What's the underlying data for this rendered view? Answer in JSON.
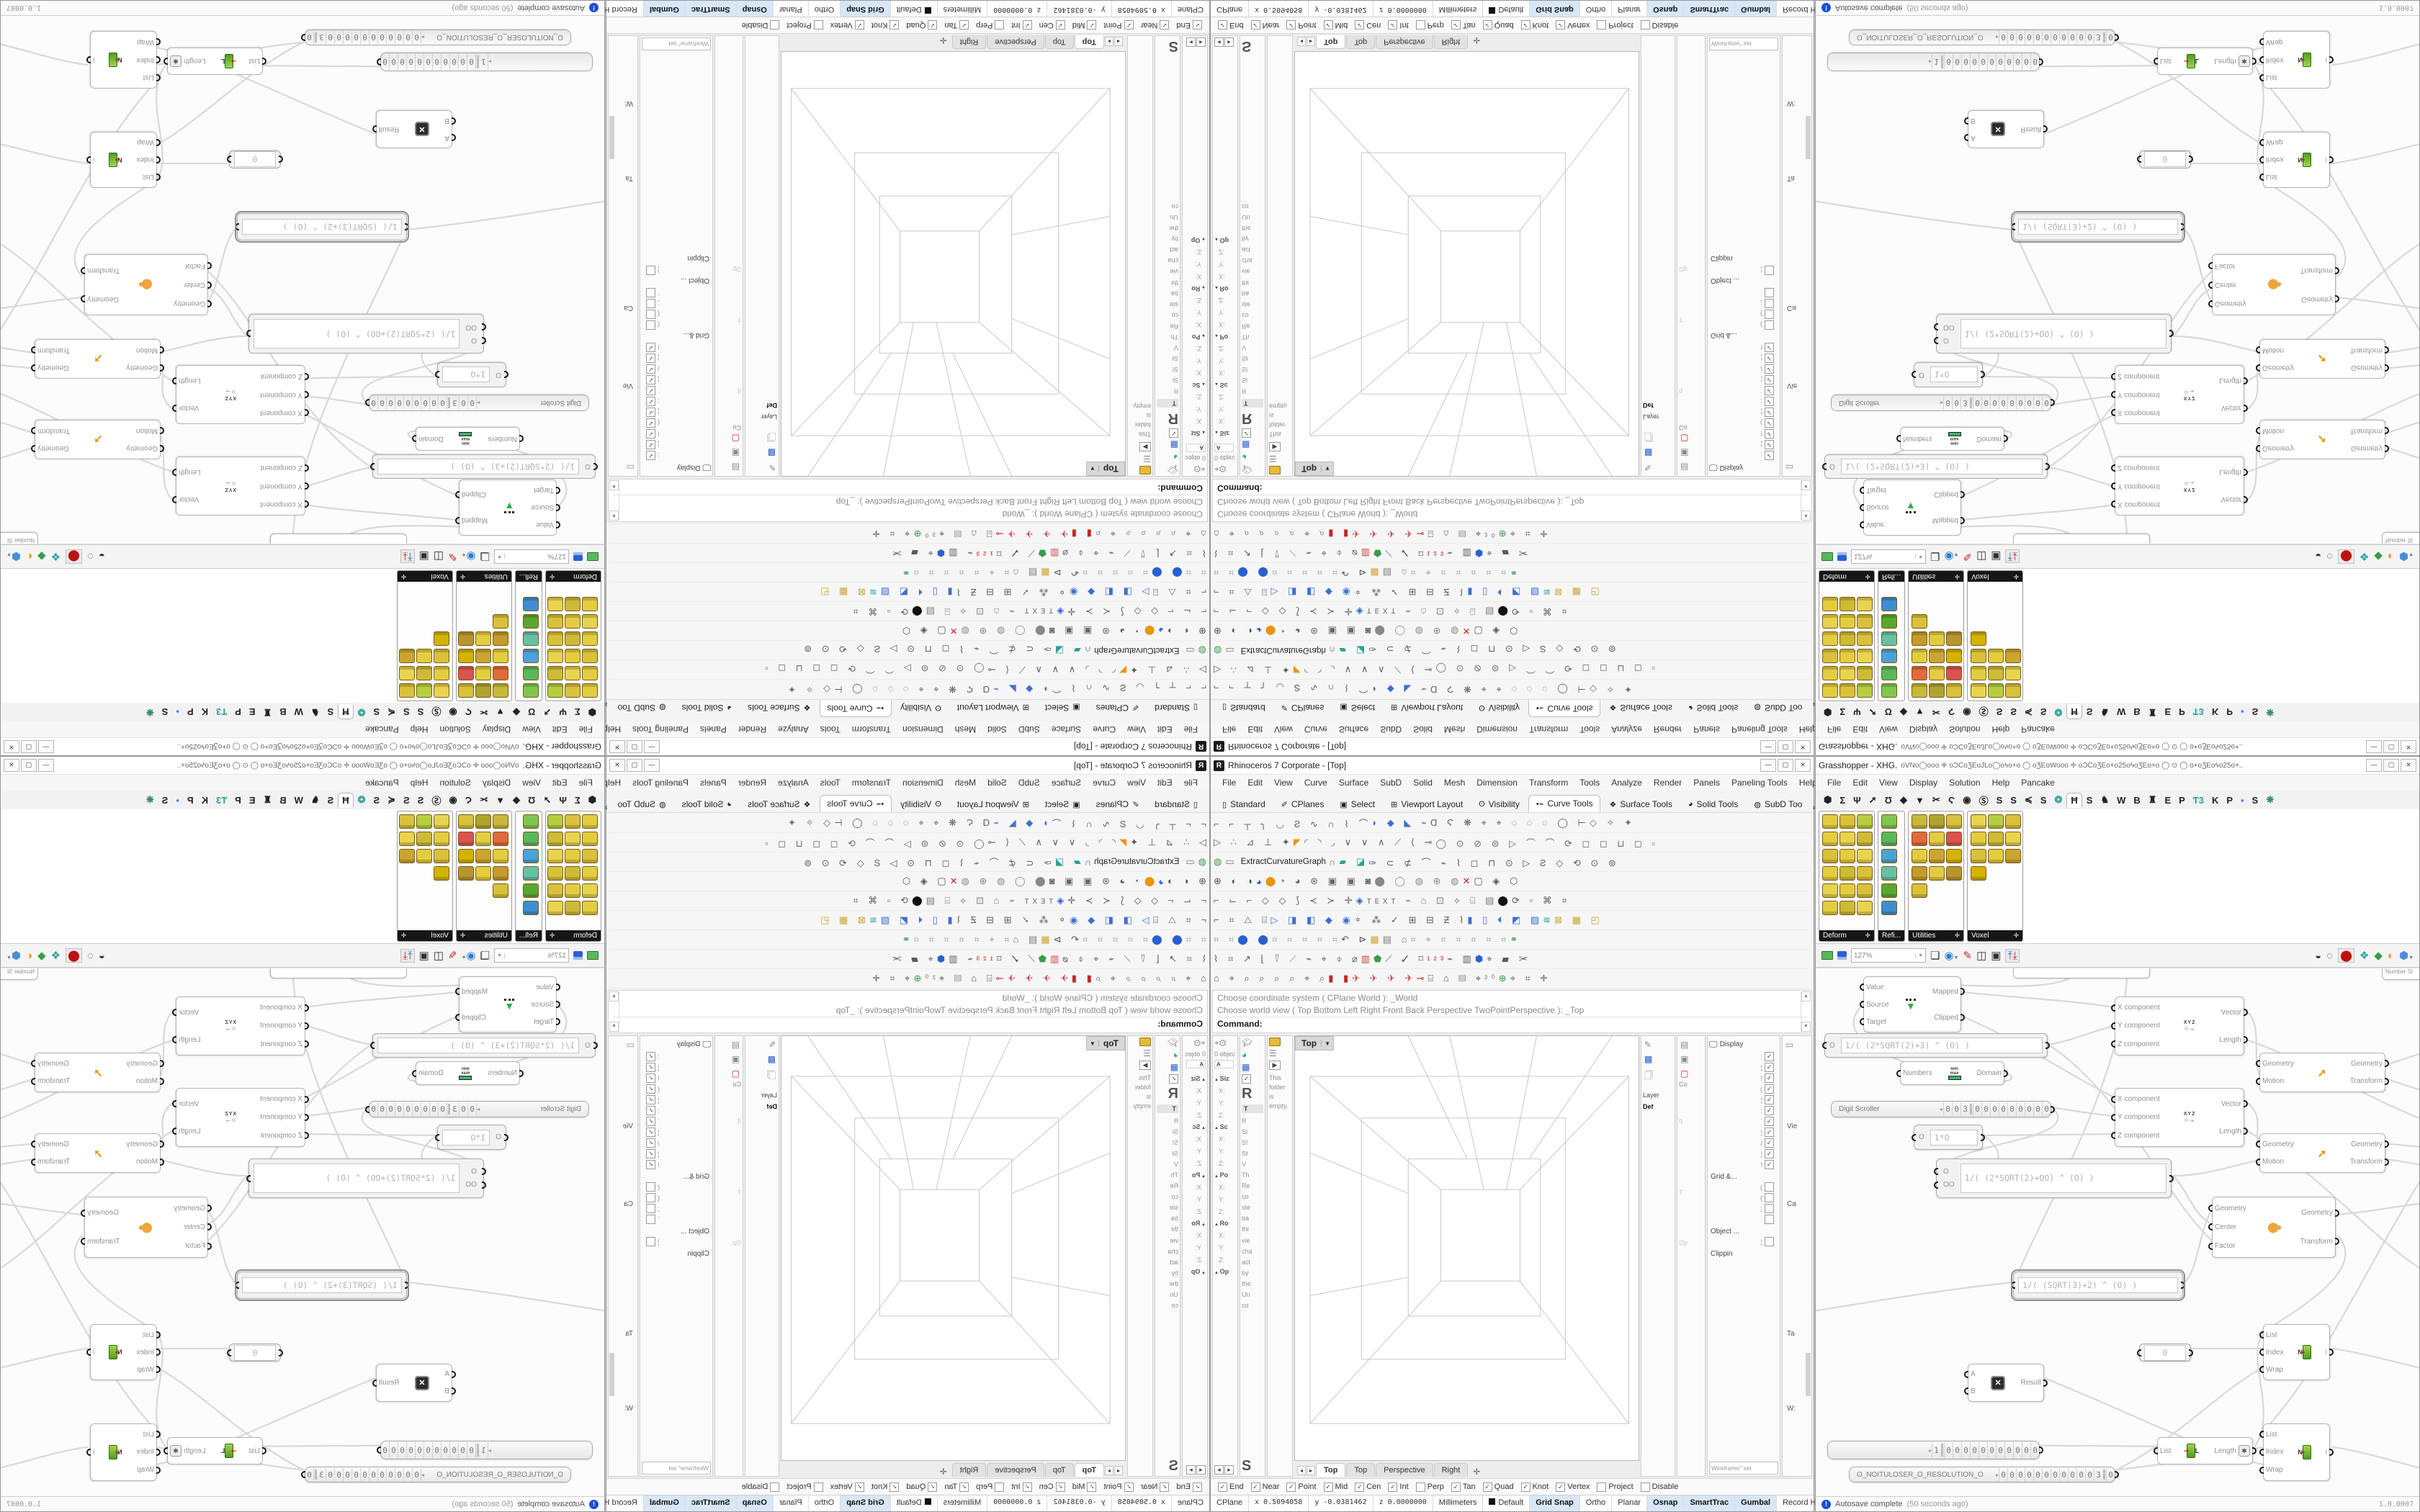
{
  "rhino": {
    "title": "Rhinoceros 7 Corporate - [Top]",
    "window_buttons": {
      "min": "—",
      "max": "▢",
      "close": "✕"
    },
    "menu": [
      "File",
      "Edit",
      "View",
      "Curve",
      "Surface",
      "SubD",
      "Solid",
      "Mesh",
      "Dimension",
      "Transform",
      "Tools",
      "Analyze",
      "Render",
      "Panels",
      "Paneling Tools",
      "Help"
    ],
    "toolbar_tabs": [
      {
        "i": "▯",
        "t": "Standard"
      },
      {
        "i": "✐",
        "t": "CPlanes"
      },
      {
        "i": "▣",
        "t": "Select"
      },
      {
        "i": "⊞",
        "t": "Viewport Layout"
      },
      {
        "i": "ʘ",
        "t": "Visibility"
      },
      {
        "i": "•⌁",
        "t": "Curve Tools",
        "sel": true
      },
      {
        "i": "❖",
        "t": "Surface Tools"
      },
      {
        "i": "◕",
        "t": "Solid Tools"
      },
      {
        "i": "◍",
        "t": "SubD Too"
      }
    ],
    "toolbar_tabs_more": "»",
    "toolbar_rows": [
      [
        {
          "t": "⌐ ⌐ ┬ ╮ ◡ Ƨ ∿ ∩ ⌇ ⌒",
          "c": "#5c5c5c"
        },
        {
          "t": "◗ ◆ ◣ ⌁",
          "c": "#3e6fd0"
        },
        {
          "t": "Ɑ Ϛ ❋ ⌖ ⌖ ◌ ◌ ◌ ◯ ⊢",
          "c": "#5c5c5c"
        },
        {
          "t": "◇ ✧ ✦",
          "c": "#6c6c6c"
        }
      ],
      [
        {
          "t": "▷ ∴ ⊿ ⊥ ✦",
          "c": "#5c5c5c"
        },
        {
          "t": "◤",
          "c": "#e8960c"
        },
        {
          "t": "◜ ◝ ◞ ∨ ∨ ∧ ⟋ ⟨ ⊸",
          "c": "#5c5c5c"
        },
        {
          "t": "◯ ⊙ ⊘ ⊜ ▷ ⌒ ⌒ ⟳ ◻ ◻ ⊔ ◻ ▫",
          "c": "#6a6a6a"
        }
      ],
      [
        {
          "t": "◍",
          "c": "#3a9a4a"
        },
        {
          "t": "▭",
          "c": "#777777"
        },
        {
          "t": "ExtractCurvatureGraph",
          "c": "#222222",
          "lbl": true
        },
        {
          "t": "∩",
          "c": "#5c5c5c"
        },
        {
          "t": "▰ ◪",
          "c": "#2aa198"
        },
        {
          "t": "✑ ⊂ ⊄ ⌒ ⌁ ⌇ ◻ ⊓ ⊙ ▷ Ƨ ◇ ⟲ ⊙ ⊚",
          "c": "#5c5c5c"
        }
      ],
      [
        {
          "t": "⊕ ◐ ◑",
          "c": "#555555"
        },
        {
          "t": "◕",
          "c": "#2a5fd0"
        },
        {
          "t": "⬤",
          "c": "#e8960c"
        },
        {
          "t": "◔ ◕ ⊛ ▣ ▣ ◙",
          "c": "#666666"
        },
        {
          "t": "⬤ ◯ ◍ ⊕ ◍",
          "c": "#888888"
        },
        {
          "t": "✕",
          "c": "#cc2222"
        },
        {
          "t": "▢ ◈ ⬡",
          "c": "#555555"
        }
      ],
      [
        {
          "t": "⌐ ⌙ ⌐ ◇ ◇ ⟆ ≺ ≻ ✛",
          "c": "#5c5c5c"
        },
        {
          "t": "◈",
          "c": "#2a5fd0"
        },
        {
          "t": "ᴛᴇxᴛ ⌁ ⌂ ⊡ ⟡ ⌸ ▤",
          "c": "#777777"
        },
        {
          "t": "⬤",
          "c": "#111111"
        },
        {
          "t": "⟳ ▫ ⌘ ⌗",
          "c": "#5c5c5c"
        }
      ],
      [
        {
          "t": "⌐ ⌗ △ ⌸",
          "c": "#5c5c5c"
        },
        {
          "t": "▷ ◨ ◧ ◆ ◉",
          "c": "#3e6fd0"
        },
        {
          "t": "⚬ ⁂ ✓ ⊞ ⊟ Ƶ ⌇",
          "c": "#5c5c5c"
        },
        {
          "t": "▮ ▯ ⏴ ◩ ▨",
          "c": "#3e6fd0"
        },
        {
          "t": "≋",
          "c": "#2aa198"
        },
        {
          "t": "⊠ ▦ ◰",
          "c": "#caa52f"
        }
      ],
      [
        {
          "t": "⌗ ⌗",
          "c": "#999999"
        },
        {
          "t": "⬤ ⬤",
          "c": "#2a5fd0"
        },
        {
          "t": "⌗ ⌗ ⌗ ⌗ ⌗",
          "c": "#999999"
        },
        {
          "t": "↶ ⊳",
          "c": "#555555"
        },
        {
          "t": "▦",
          "c": "#caa52f"
        },
        {
          "t": "▤ ⌂",
          "c": "#777777"
        },
        {
          "t": "⌗ ⌖ ⌗ ⌗ ⌗ ⌗ ⌗",
          "c": "#999999"
        },
        {
          "t": "⚭",
          "c": "#3a9a4a"
        }
      ],
      [
        {
          "t": "⌇ ⌗ ↗ ⌊ ⍢ ⟋ ⌁ ⌖ ⌽ ⌀",
          "c": "#5c5c5c"
        },
        {
          "t": "▥",
          "c": "#cc4444"
        },
        {
          "t": "⬟",
          "c": "#3a9a4a"
        },
        {
          "t": "⟋ ✓ ⌑",
          "c": "#5c5c5c"
        },
        {
          "t": "¹²³",
          "c": "#cc2222"
        },
        {
          "t": "⌁ ▥",
          "c": "#5c5c5c"
        },
        {
          "t": "⬢",
          "c": "#2a5fd0"
        },
        {
          "t": "⌖ ▰ ✂",
          "c": "#5c5c5c"
        }
      ],
      [
        {
          "t": "⌂ ⌖ ⌕ ⌕ ⌕ ⌕ ⌖ ⌕",
          "c": "#5c5c5c"
        },
        {
          "t": "▮ ▮",
          "c": "#cc2222"
        },
        {
          "t": "✈ ✈ ✈ ✈",
          "c": "#cc4444"
        },
        {
          "t": "⊸",
          "c": "#cc2222"
        },
        {
          "t": "⌸ ⌂ ▤ ⌖",
          "c": "#555555"
        },
        {
          "t": "²⁰",
          "c": "#777777"
        },
        {
          "t": "⊕",
          "c": "#3a9a4a"
        },
        {
          "t": "⌖ ⌗ ✛",
          "c": "#5c5c5c"
        }
      ]
    ],
    "command": {
      "line1": "Choose coordinate system ( CPlane  World ): _World",
      "line2": "Choose world view ( Top  Bottom  Left  Right  Front  Back  Perspective  TwoPointPerspective ): _Top",
      "prompt": "Command:"
    },
    "panel1": {
      "count_label": "0 objec",
      "field": "A",
      "rows": [
        {
          "t": "Siz",
          "k": "h"
        },
        {
          "t": "X:",
          "k": "l"
        },
        {
          "t": "Y:",
          "k": "l"
        },
        {
          "t": "Z:",
          "k": "l"
        },
        {
          "t": "Sc",
          "k": "h"
        },
        {
          "t": "X:",
          "k": "l"
        },
        {
          "t": "Y:",
          "k": "l"
        },
        {
          "t": "Z:",
          "k": "l"
        },
        {
          "t": "Po",
          "k": "h"
        },
        {
          "t": "X:",
          "k": "l"
        },
        {
          "t": "Y:",
          "k": "l"
        },
        {
          "t": "Z:",
          "k": "l"
        },
        {
          "t": "Ro",
          "k": "h"
        },
        {
          "t": "X:",
          "k": "l"
        },
        {
          "t": "Y:",
          "k": "l"
        },
        {
          "t": "Z:",
          "k": "l"
        },
        {
          "t": "Op",
          "k": "h"
        }
      ]
    },
    "panel2": {
      "big": "R",
      "tab": "T",
      "rows": [
        {
          "t": "R",
          "k": "t"
        },
        {
          "t": "Si",
          "k": "t"
        },
        {
          "t": "S!",
          "k": "t"
        },
        {
          "t": "St",
          "k": "t"
        },
        {
          "t": "V",
          "k": "t"
        },
        {
          "t": "Th",
          "k": "t"
        },
        {
          "t": "Re",
          "k": "t"
        },
        {
          "t": "co",
          "k": "t"
        },
        {
          "t": "ste",
          "k": "t"
        },
        {
          "t": "ba",
          "k": "t"
        },
        {
          "t": "thr",
          "k": "t"
        },
        {
          "t": "vie",
          "k": "t"
        },
        {
          "t": "cha",
          "k": "t"
        },
        {
          "t": "act",
          "k": "t"
        },
        {
          "t": "by",
          "k": "t"
        },
        {
          "t": "the",
          "k": "t"
        },
        {
          "t": "Un",
          "k": "t"
        },
        {
          "t": "co",
          "k": "t"
        }
      ],
      "big2": "S"
    },
    "panel3": {
      "text": "This folder is empty."
    },
    "viewport": {
      "label": "Top",
      "tabs": [
        "Top",
        "Top",
        "Perspective",
        "Right"
      ],
      "plus": "✛"
    },
    "layer_panel": {
      "title": "Layer",
      "row": "Def"
    },
    "strip2": {
      "label": "Co",
      "faint": [
        "q",
        "T",
        "Op"
      ]
    },
    "display_panel": {
      "title": "Display",
      "checked": [
        {
          "t": ":",
          "c": 1
        },
        {
          "t": "¦",
          "c": 1
        },
        {
          "t": "!",
          "c": 1
        },
        {
          "t": "(",
          "c": 1
        },
        {
          "t": "¦",
          "c": 1
        },
        {
          "t": ":",
          "c": 1
        },
        {
          "t": "˙",
          "c": 1
        },
        {
          "t": "¦",
          "c": 1
        },
        {
          "t": "/",
          "c": 1
        },
        {
          "t": "¦",
          "c": 1
        },
        {
          "t": "!",
          "c": 1
        }
      ],
      "grid_label": "Grid &...",
      "grid_items": [
        {
          "t": "(",
          "c": 0
        },
        {
          "t": "(",
          "c": 0
        },
        {
          "t": ";",
          "c": 0
        },
        {
          "t": "˙",
          "c": 0
        }
      ],
      "object_label": "Object ...",
      "object_items": [
        {
          "t": "¦",
          "c": 0
        }
      ],
      "clip_label": "Clippin",
      "wfbox": "Wireframe\" set"
    },
    "props_strip": {
      "l1": "Vie",
      "l2": "Ca",
      "l3": "Ta",
      "l4": "W:"
    },
    "osnap": [
      {
        "t": "End",
        "c": 1
      },
      {
        "t": "Near",
        "c": 1
      },
      {
        "t": "Point",
        "c": 1
      },
      {
        "t": "Mid",
        "c": 1
      },
      {
        "t": "Cen",
        "c": 1
      },
      {
        "t": "Int",
        "c": 1
      },
      {
        "t": "Perp",
        "c": 0
      },
      {
        "t": "Tan",
        "c": 1
      },
      {
        "t": "Quad",
        "c": 1
      },
      {
        "t": "Knot",
        "c": 1
      },
      {
        "t": "Vertex",
        "c": 1
      },
      {
        "t": "Project",
        "c": 0
      },
      {
        "t": "Disable",
        "c": 0
      }
    ],
    "status": {
      "cplane": "CPlane",
      "x": "x 0.5094058",
      "y": "y -0.0381462",
      "z": "z 0.0000000",
      "units": "Millimeters",
      "layer": "Default",
      "grid": "Grid Snap",
      "ortho": "Ortho",
      "planar": "Planar",
      "osnap": "Osnap",
      "smarttrack": "SmartTrac",
      "gumball": "Gumbal",
      "record": "Record History",
      "filter": "Filter"
    }
  },
  "gh": {
    "title": "Grasshopper - XHG.",
    "title_glyphs": "oVNo◯ooo ✛ oϽCoƷEoJLo◯oϟo+o   ◯   oƷEoWooo ✛ oϽCoƷEo+o25oϟoƷEo+o   ◯  ⊙  ◯   o+oƷEoϟo25o+..",
    "menu": [
      "File",
      "Edit",
      "View",
      "Display",
      "Solution",
      "Help",
      "Pancake"
    ],
    "tabs": [
      {
        "t": "⬢"
      },
      {
        "t": "Σ"
      },
      {
        "t": "Ψ"
      },
      {
        "t": "➚"
      },
      {
        "t": "Ʊ"
      },
      {
        "t": "◆"
      },
      {
        "t": "▼"
      },
      {
        "t": "✂"
      },
      {
        "t": "Ϛ"
      },
      {
        "t": "◉"
      },
      {
        "t": "Ⓢ"
      },
      {
        "t": "S"
      },
      {
        "t": "S"
      },
      {
        "t": "≼"
      },
      {
        "t": "S"
      },
      {
        "t": "❂",
        "c": "#2aa198"
      },
      {
        "t": "Ħ",
        "sel": true
      },
      {
        "t": "S"
      },
      {
        "t": "♞"
      },
      {
        "t": "W"
      },
      {
        "t": "B"
      },
      {
        "t": "♜"
      },
      {
        "t": "E"
      },
      {
        "t": "P"
      },
      {
        "t": "Ƭ3",
        "c": "#2aa198"
      },
      {
        "t": "K"
      },
      {
        "t": "P"
      },
      {
        "t": "▪",
        "c": "#3b82f6"
      },
      {
        "t": "S"
      },
      {
        "t": "❋",
        "c": "#2e8b57"
      }
    ],
    "palettes": [
      {
        "label": "Deform",
        "plus": "✛",
        "cols": 3,
        "cells": [
          "#e3cd3f",
          "#d9c13a",
          "#b5cf3e",
          "#e3cd3f",
          "#e8d44d",
          "#cdbb35",
          "#d9c13a",
          "#e3cd3f",
          "#e8d44d",
          "#e3cd3f",
          "#cdbb35",
          "#d9c13a",
          "#e8d44d",
          "#e3cd3f",
          "#d9c13a",
          "#e3cd3f",
          "#cdbb35",
          "#e8d44d"
        ]
      },
      {
        "label": "Refi...",
        "plus": "",
        "cols": 1,
        "cells": [
          "#7ec850",
          "#58b85c",
          "#4aa3d8",
          "#66c2a4",
          "#58a830",
          "#3e8fd0"
        ]
      },
      {
        "label": "Utilities",
        "plus": "✛",
        "cols": 3,
        "cells": [
          "#c8b93a",
          "#b0a42c",
          "#d9c13a",
          "#e06a3a",
          "#e3cd3f",
          "#d9534f",
          "#e3cd3f",
          "#caa52f",
          "#d4b200",
          "#c49a2a",
          "#e3cd3f",
          "#b8952f",
          "#d9c13a"
        ]
      },
      {
        "label": "Voxel",
        "plus": "✛",
        "cols": 3,
        "cells": [
          "#e8d44d",
          "#b5cf3e",
          "#d9c13a",
          "#e3cd3f",
          "#cdbb35",
          "#e8d44d",
          "#d9c13a",
          "#e3cd3f",
          "#caa52f",
          "#d4b200"
        ]
      }
    ],
    "toolbar": {
      "zoom": "127%"
    },
    "nodes": {
      "partial_slider": "Number Sl",
      "remap": {
        "in": [
          "Value",
          "Source",
          "Target"
        ],
        "out": [
          "Mapped",
          "Clipped"
        ]
      },
      "expr1": {
        "pin": "O",
        "text": "1/( (2*SQRT(2)+3) ^ (O) )"
      },
      "bounds": {
        "in": "Numbers",
        "out": "Domain",
        "ico_top": "min",
        "ico_bot": "max"
      },
      "ds1": {
        "name": "Digit Scroller",
        "arrow": "▸",
        "left": [
          "0",
          "0",
          "3"
        ],
        "right": [
          "0",
          "0",
          "0",
          "0",
          "0",
          "0",
          "0",
          "0",
          "0"
        ]
      },
      "panel10": {
        "pin": "O",
        "text": "1*O"
      },
      "expr2": {
        "pins": [
          "O",
          "OO"
        ],
        "text": "1/( (2*SQRT(2)+OO) ^ (O) )"
      },
      "vec": {
        "in": [
          "X component",
          "Y component",
          "Z component"
        ],
        "out": [
          "Vector",
          "Length"
        ],
        "ico": "XYZ",
        "ico2": "○→"
      },
      "move": {
        "in": [
          "Geometry",
          "Motion"
        ],
        "out": [
          "Geometry",
          "Transform"
        ]
      },
      "scale": {
        "in": [
          "Geometry",
          "Center",
          "Factor"
        ],
        "out": [
          "Geometry",
          "Transform"
        ]
      },
      "selexpr": {
        "text": "1/( (SQRT(3)+2) ^ (O) )"
      },
      "zero": {
        "text": "0"
      },
      "mult": {
        "in": [
          "A",
          "B"
        ],
        "out": "Result"
      },
      "listitem": {
        "in": [
          "List",
          "Index",
          "Wrap"
        ],
        "out": "i",
        "n": "N"
      },
      "listlen": {
        "in": "List",
        "out": "Length",
        "ast": "✱",
        "n": "L"
      },
      "ls": {
        "arrow": "▸",
        "first": "1",
        "zeros": [
          "0",
          "0",
          "0",
          "0",
          "0",
          "0",
          "0",
          "0",
          "0",
          "0",
          "0"
        ]
      },
      "ns": {
        "name": "O_NOITULOSER_O_RESOLUTION_O",
        "arrow": "▸",
        "zeros": [
          "0",
          "0",
          "0",
          "0",
          "0",
          "0",
          "0",
          "0",
          "0",
          "0",
          "0"
        ],
        "val": "3",
        "last": "0"
      }
    },
    "status": {
      "autosave": "Autosave complete",
      "ago": "(50 seconds ago)",
      "version": "1.0.0007"
    }
  }
}
